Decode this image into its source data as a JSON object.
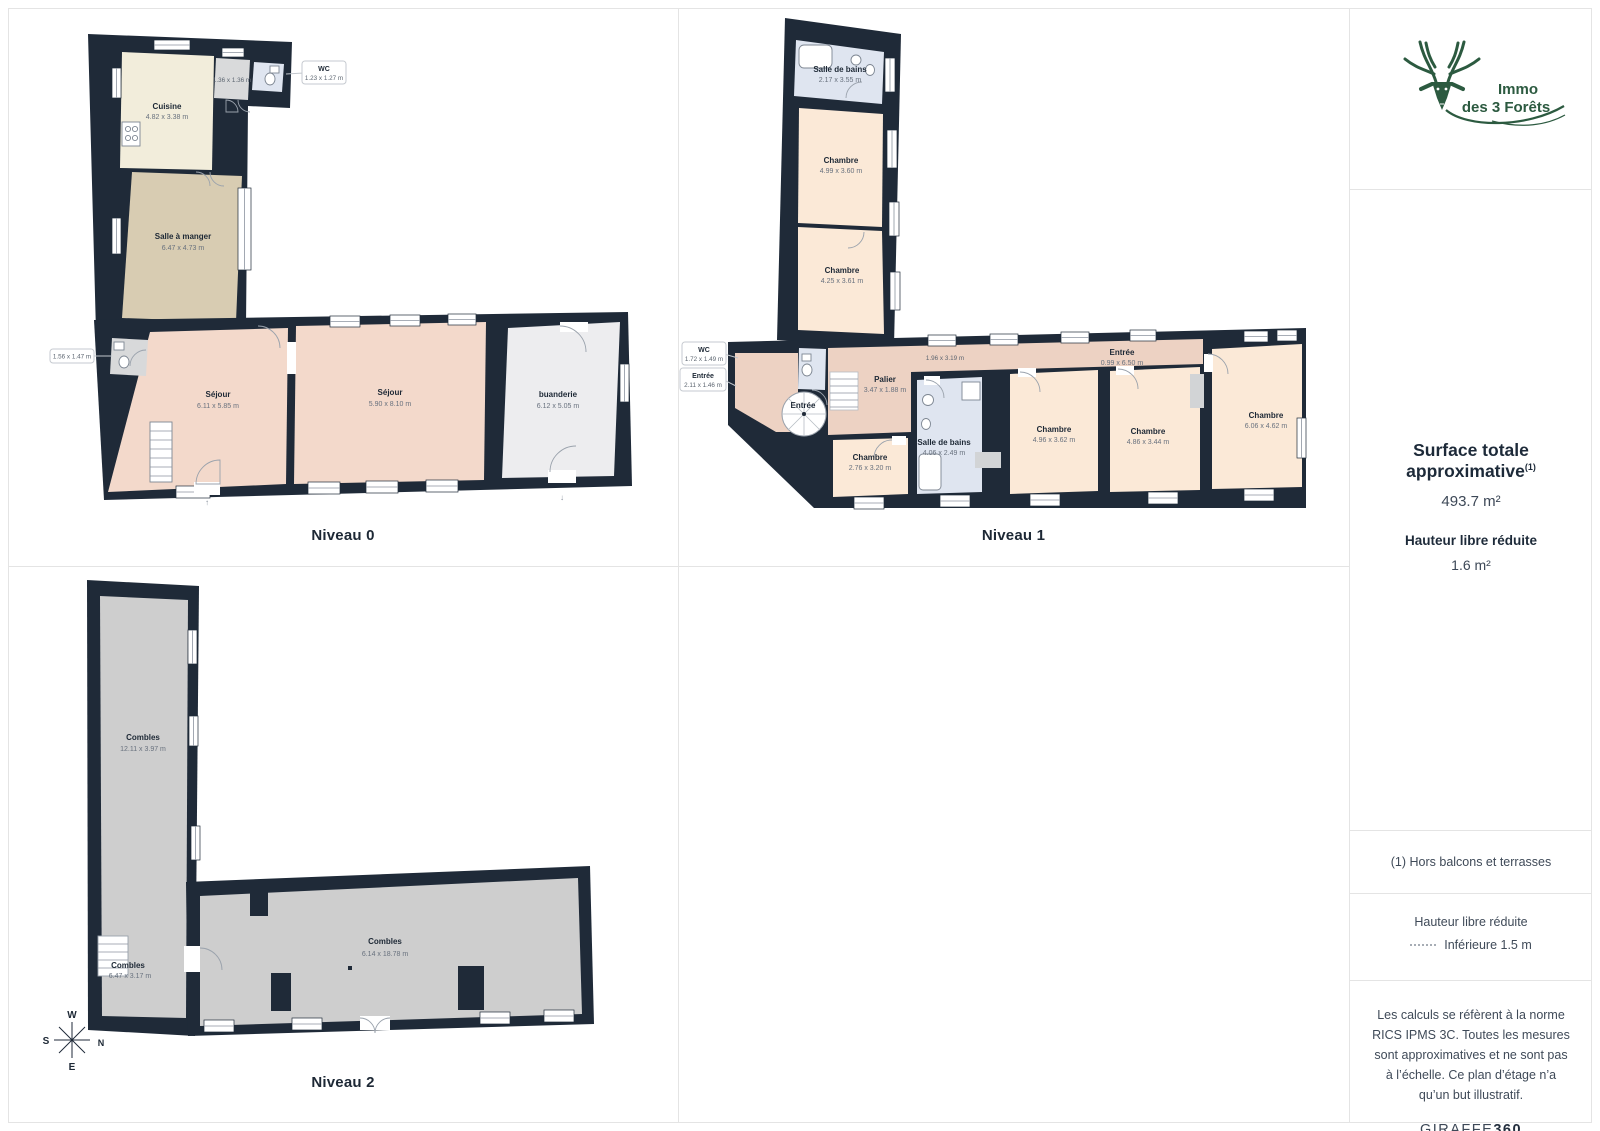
{
  "floors": {
    "n0": {
      "title": "Niveau 0",
      "rooms": {
        "cuisine": {
          "name": "Cuisine",
          "dims": "4.82 x 3.38 m"
        },
        "salle_a_manger": {
          "name": "Salle à manger",
          "dims": "6.47 x 4.73 m"
        },
        "sejour1": {
          "name": "Séjour",
          "dims": "6.11 x 5.85 m"
        },
        "sejour2": {
          "name": "Séjour",
          "dims": "5.90 x 8.10 m"
        },
        "buanderie": {
          "name": "buanderie",
          "dims": "6.12 x 5.05 m"
        }
      },
      "small_dims": "1.36 x 1.36 m",
      "callout_wc": {
        "name": "WC",
        "dims": "1.23 x 1.27 m"
      },
      "callout_left": {
        "dims": "1.56 x 1.47 m"
      }
    },
    "n1": {
      "title": "Niveau 1",
      "rooms": {
        "sdb_top": {
          "name": "Salle de bains",
          "dims": "2.17 x 3.55 m"
        },
        "chambre_t1": {
          "name": "Chambre",
          "dims": "4.99 x 3.60 m"
        },
        "chambre_t2": {
          "name": "Chambre",
          "dims": "4.25 x 3.61 m"
        },
        "palier": {
          "name": "Palier",
          "dims": "3.47 x 1.88 m"
        },
        "entree_corridor": {
          "name": "Entrée",
          "dims": "0.99 x 6.50 m"
        },
        "chambre_small": {
          "name": "Chambre",
          "dims": "2.76 x 3.20 m"
        },
        "sdb_bottom": {
          "name": "Salle de bains",
          "dims": "4.06 x 2.49 m"
        },
        "chambre_a": {
          "name": "Chambre",
          "dims": "4.96 x 3.62 m"
        },
        "chambre_b": {
          "name": "Chambre",
          "dims": "4.86 x 3.44 m"
        },
        "chambre_c": {
          "name": "Chambre",
          "dims": "6.06 x 4.62 m"
        }
      },
      "entree_label": "Entrée",
      "corridor_dims": "1.96 x 3.19 m",
      "callout_wc": {
        "name": "WC",
        "dims": "1.72 x 1.49 m"
      },
      "callout_entree": {
        "name": "Entrée",
        "dims": "2.11 x 1.46 m"
      }
    },
    "n2": {
      "title": "Niveau 2",
      "rooms": {
        "combles_long": {
          "name": "Combles",
          "dims": "12.11 x 3.97 m"
        },
        "combles_small": {
          "name": "Combles",
          "dims": "6.47 x 3.17 m"
        },
        "combles_big": {
          "name": "Combles",
          "dims": "6.14 x 18.78 m"
        }
      },
      "compass": {
        "n": "N",
        "s": "S",
        "e": "E",
        "w": "W"
      }
    }
  },
  "sidebar": {
    "logo": {
      "line1": "Immo",
      "line2": "des 3 Forêts"
    },
    "surface_title": "Surface totale approximative",
    "surface_sup": "(1)",
    "surface_value": "493.7 m²",
    "height_title": "Hauteur libre réduite",
    "height_value": "1.6 m²",
    "note1": "(1) Hors balcons et terrasses",
    "legend_title": "Hauteur libre réduite",
    "legend_item": "Inférieure 1.5 m",
    "disclaimer": "Les calculs se réfèrent à la norme RICS IPMS 3C. Toutes les mesures sont approximatives et ne sont pas à l’échelle. Ce plan d’étage n’a qu’un but illustratif.",
    "brand_normal": "GIRAFFE",
    "brand_bold": "360"
  },
  "colors": {
    "wall": "#1f2a38",
    "chambre_fill": "#fbe9d7",
    "sejour_fill": "#f3d9cb",
    "corridor_fill": "#edd2c3",
    "bath_fill": "#dfe5f0",
    "kitchen_fill": "#f2eddb",
    "dining_fill": "#d8ccb2",
    "laundry_fill": "#ededef",
    "combles_fill": "#cecece",
    "brand_green": "#2c5a40"
  }
}
